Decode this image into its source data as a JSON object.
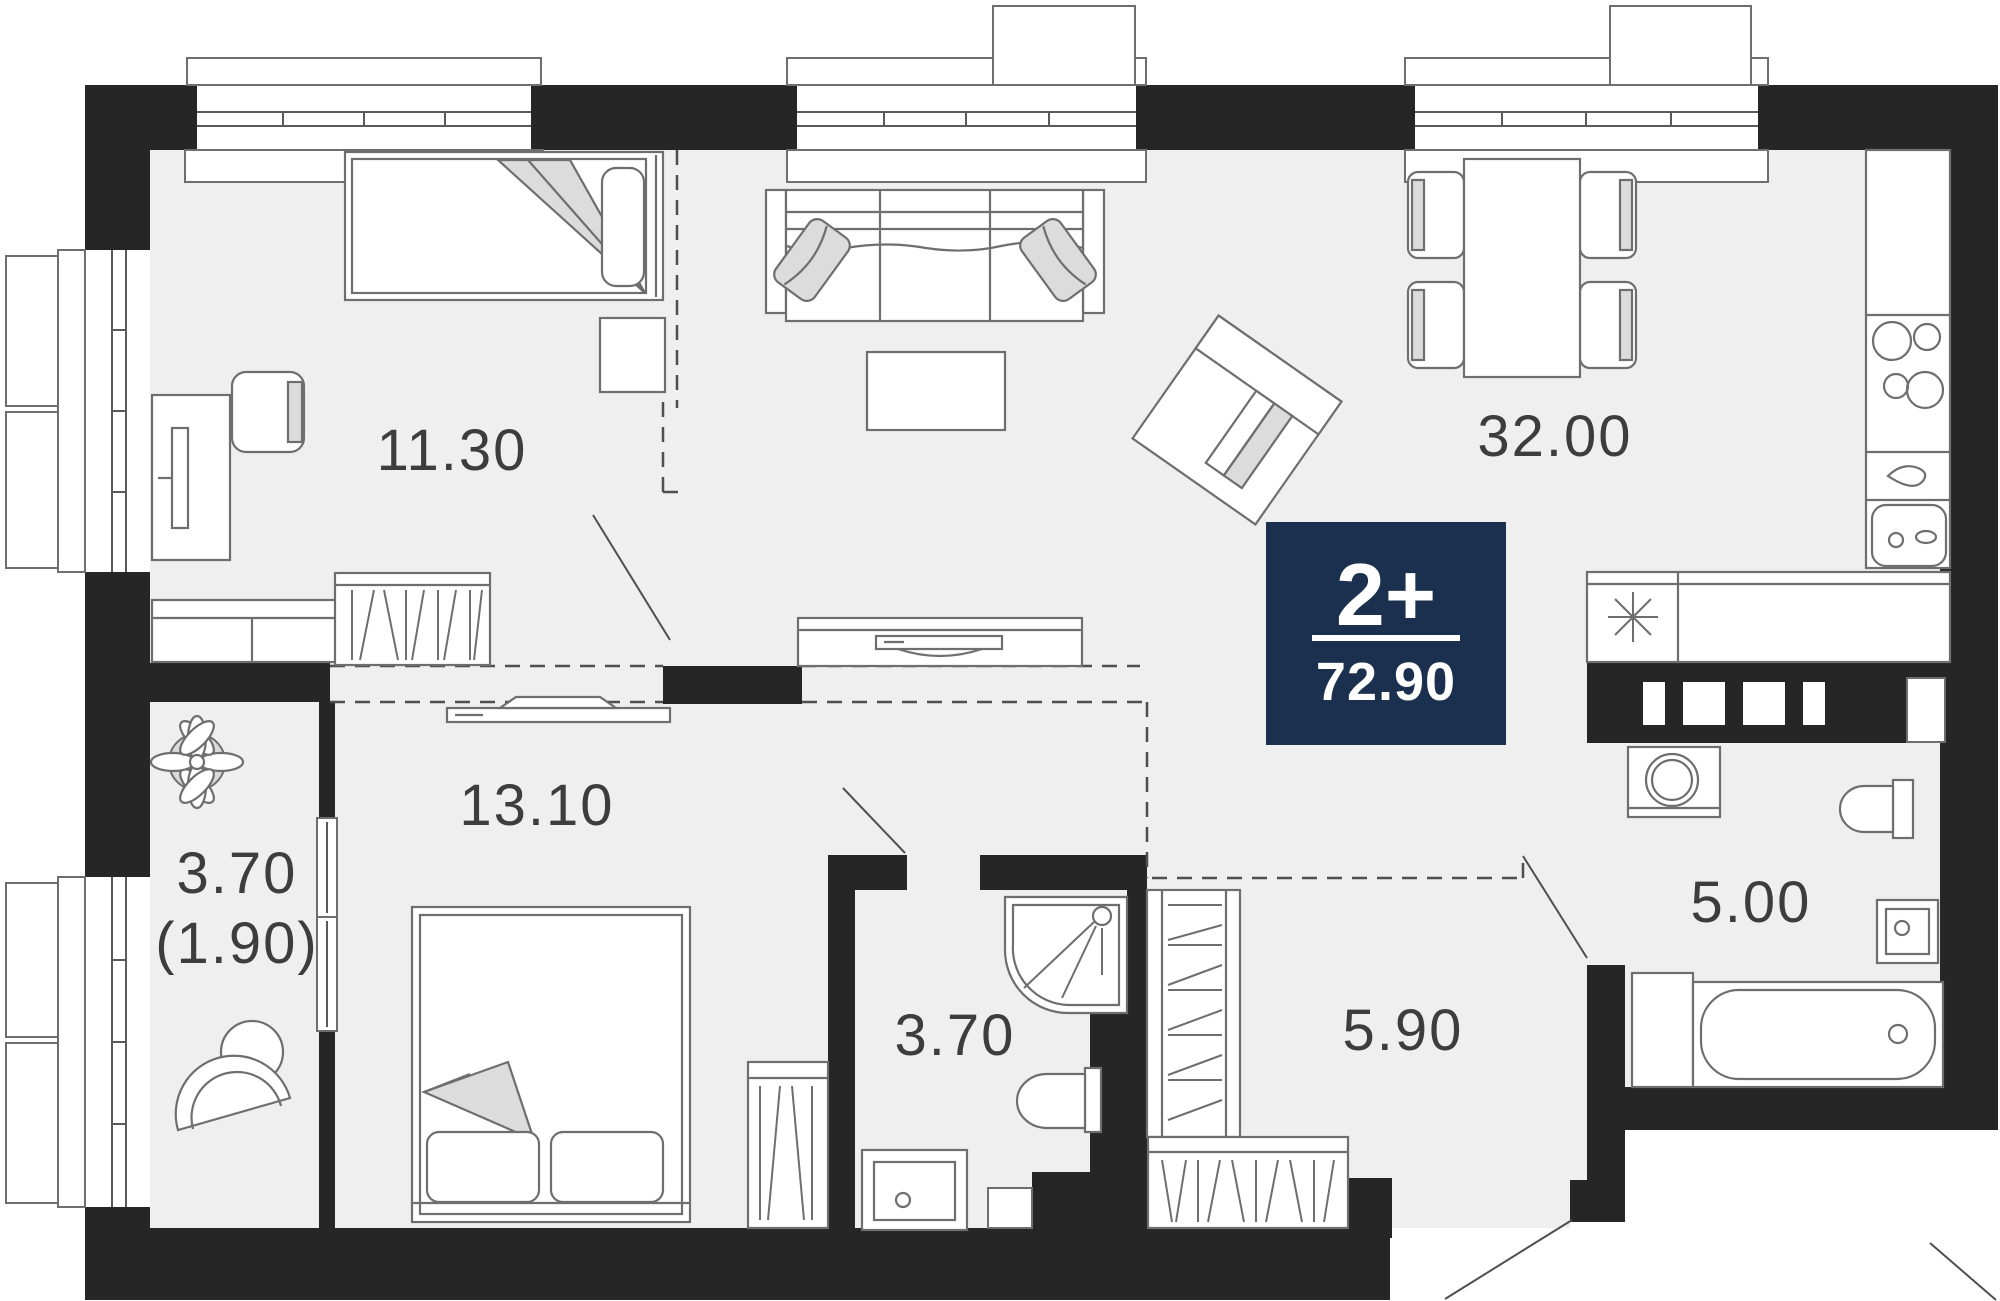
{
  "plan": {
    "title": "2-room apartment floor plan",
    "badge": {
      "rooms_label": "2+",
      "total_area": "72.90"
    },
    "rooms": [
      {
        "id": "bedroom-1",
        "label": "11.30"
      },
      {
        "id": "living-kitchen",
        "label": "32.00"
      },
      {
        "id": "bedroom-2",
        "label": "13.10"
      },
      {
        "id": "balcony",
        "label": "3.70",
        "label_secondary": "(1.90)"
      },
      {
        "id": "bathroom-shower",
        "label": "3.70"
      },
      {
        "id": "hallway",
        "label": "5.90"
      },
      {
        "id": "bathroom-bath",
        "label": "5.00"
      }
    ],
    "colors": {
      "wall": "#262626",
      "floor": "#efeff0",
      "badge_bg": "#1b2f4e",
      "furniture_line": "#6e6e6e",
      "label_text": "#3d3d3d",
      "soft_fill": "#dcdcdc"
    },
    "icons": [
      "plant-icon",
      "balcony-table-icon",
      "balcony-chair-icon",
      "single-bed-icon",
      "double-bed-icon",
      "desk-icon",
      "desk-chair-icon",
      "monitor-icon",
      "nightstand-icon",
      "dresser-icon",
      "wardrobe-icon",
      "sofa-icon",
      "pillow-icon",
      "coffee-table-icon",
      "armchair-icon",
      "tv-console-icon",
      "dining-table-icon",
      "dining-chair-icon",
      "fridge-counter-icon",
      "stove-icon",
      "kettle-icon",
      "kitchen-sink-icon",
      "asterisk-icon",
      "washing-machine-icon",
      "toilet-icon",
      "shower-icon",
      "vanity-sink-icon",
      "bathtub-icon",
      "door-swing-icon",
      "window-icon"
    ]
  }
}
